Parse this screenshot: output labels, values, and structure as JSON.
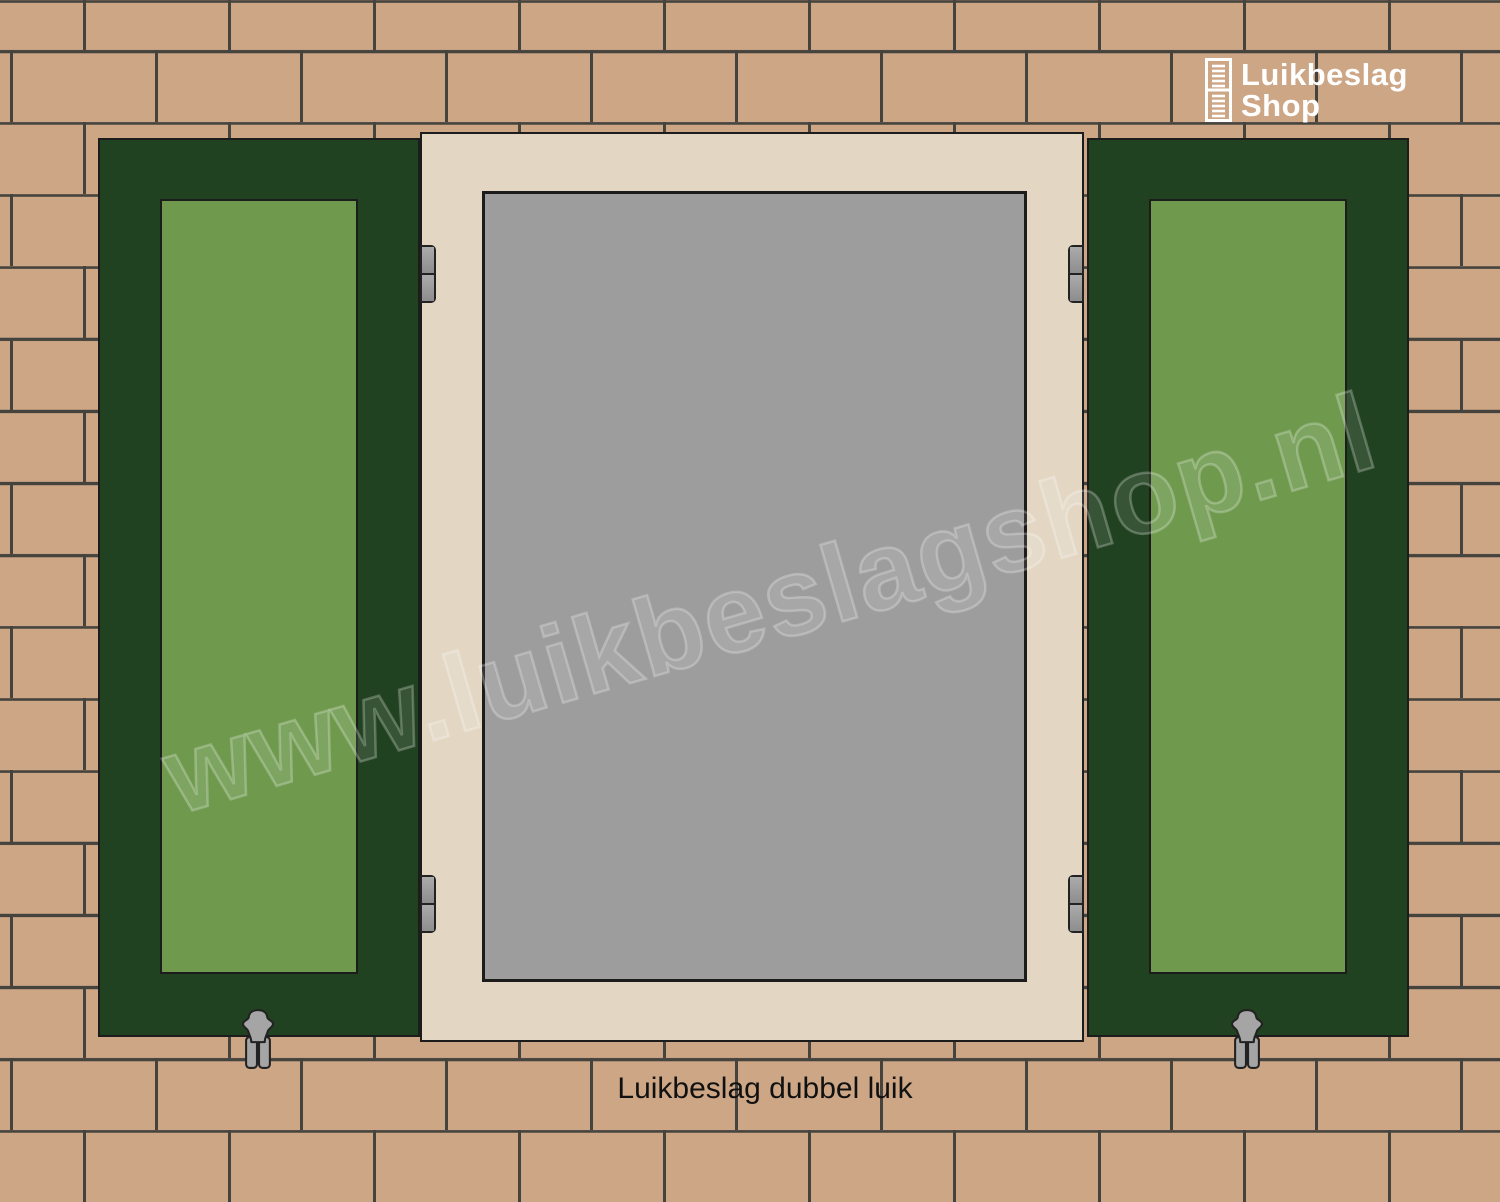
{
  "logo": {
    "brand_line1": "Luikbeslag",
    "brand_line2": "Shop"
  },
  "watermark": {
    "text": "www.luikbeslagshop.nl"
  },
  "caption": {
    "text": "Luikbeslag dubbel luik"
  },
  "colors": {
    "brick": "#cda685",
    "mortar": "#45433e",
    "shutter_green_dark": "#214220",
    "shutter_green_light": "#6f9a4e",
    "frame_cream": "#e3d7c4",
    "glass_gray": "#9d9d9d",
    "hardware_gray": "#a5a5a5",
    "outline_dark": "#1c1c1c",
    "logo_white": "#ffffff",
    "caption_black": "#111111"
  }
}
